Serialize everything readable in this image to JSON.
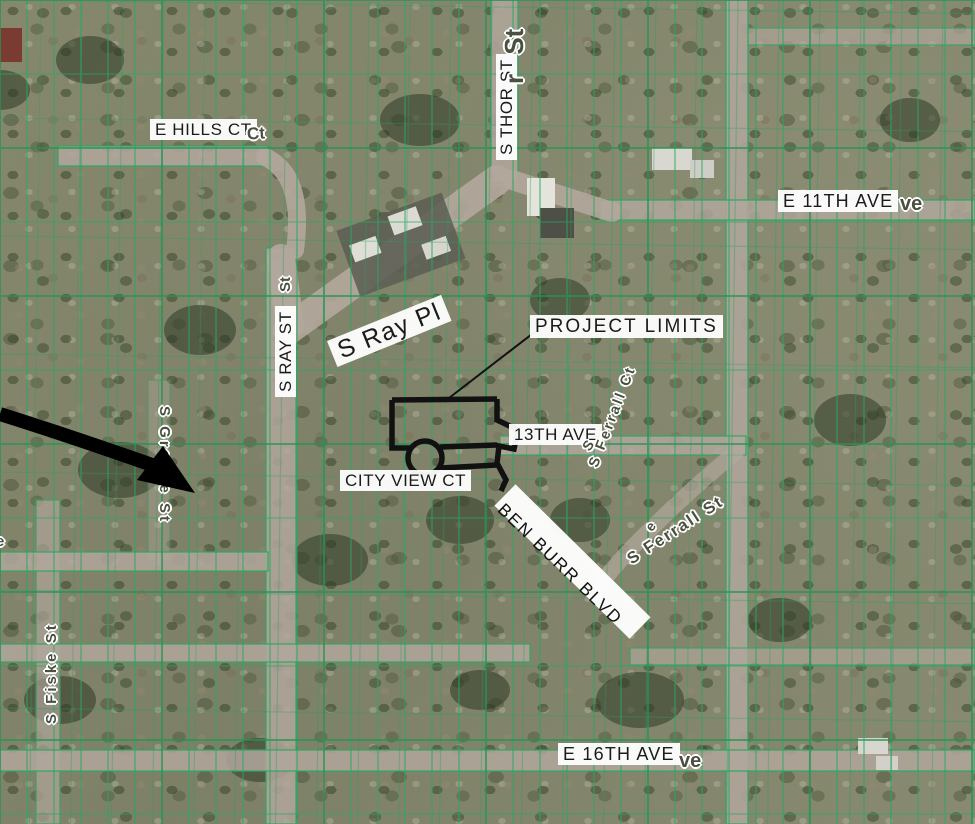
{
  "meta": {
    "map_type": "aerial parcel map with project annotations",
    "colors": {
      "parcel_line": "#2aa761",
      "street_fill": "#b2a79c",
      "label_chip_bg": "#ffffff",
      "label_chip_text": "#1b1b1b",
      "halo_label_text": "#49503f",
      "project_outline": "#111111",
      "trail_band": "#ffffff",
      "arrow": "#000000"
    },
    "icons": {
      "locator_arrow": "curved-black-arrow-pointing-at-project-area"
    }
  },
  "labels": {
    "e_hills_ct": "E HILLS CT",
    "hills_overlap": "Ct",
    "s_thor_st": "S THOR ST",
    "thor_overlap": "r St",
    "e_11th_ave": "E 11TH AVE",
    "eleventh_overlap": "ve",
    "s_ray_st": "S RAY ST",
    "ray_overlap": "St",
    "s_ray_pl": "S Ray Pl",
    "project_limits": "PROJECT LIMITS",
    "thirteenth_ave": "13TH AVE",
    "city_view_ct": "CITY VIEW CT",
    "ben_burr_blvd": "BEN BURR BLVD",
    "e_16th_ave": "E 16TH AVE",
    "sixteenth_overlap": "ve",
    "s_ferrall_ct": "S Ferrall Ct",
    "s_ferrall_st": "S Ferrall St",
    "s_greene_st": "S Greene St",
    "s_fiske_st": "S Fiske St",
    "edge_fragment": "e",
    "trail_fragment_1": "S",
    "trail_fragment_2": "e"
  }
}
